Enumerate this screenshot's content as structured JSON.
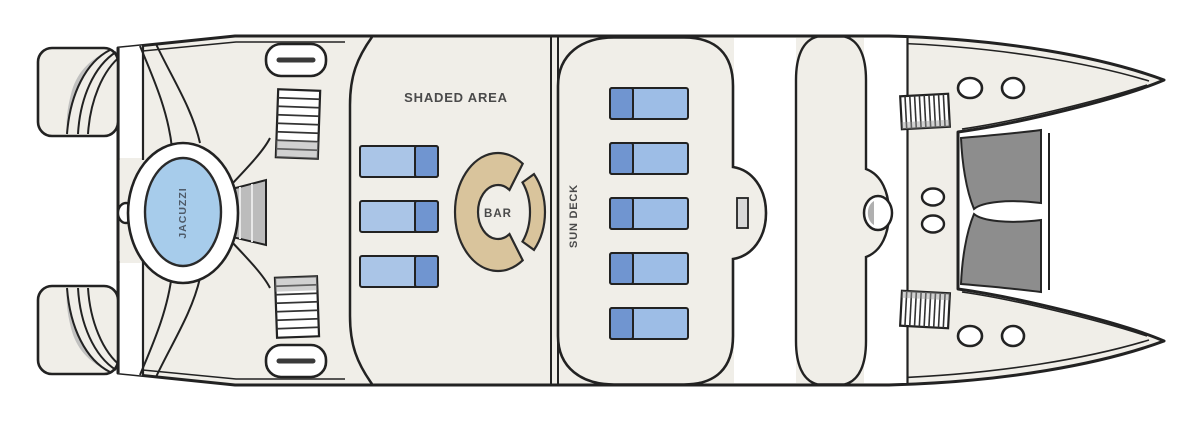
{
  "diagram": {
    "type": "catamaran-deck-plan",
    "labels": {
      "shaded_area": "SHADED AREA",
      "bar": "BAR",
      "sun_deck": "SUN DECK",
      "jacuzzi": "JACUZZI"
    },
    "colors": {
      "deck": "#f0eee8",
      "outline": "#222222",
      "white": "#ffffff",
      "lounger_body": "#9dbde6",
      "lounger_body_light": "#aac5e7",
      "lounger_pillow": "#7095d0",
      "bar_counter": "#d9c49c",
      "jacuzzi_water": "#a7cceb",
      "net": "#8d8d8d",
      "steps_gray": "#bcbcbc",
      "label_text": "#4a4a4a"
    },
    "counts": {
      "shaded_area_loungers": 3,
      "sun_deck_loungers": 5,
      "bow_hatches": 4,
      "stern_hatches": 2
    }
  }
}
